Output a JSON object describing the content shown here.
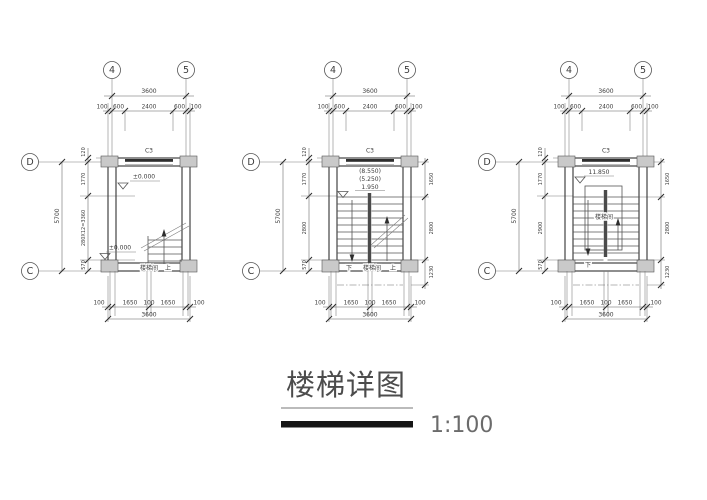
{
  "title": {
    "text": "楼梯详图",
    "scale": "1:100"
  },
  "colors": {
    "line": "#555555",
    "column_fill": "#c9c9c9",
    "window_band": "#2e2e2e",
    "title_bar": "#151515"
  },
  "plans": [
    {
      "grid_top": [
        "4",
        "5"
      ],
      "grid_left": [
        "D",
        "C"
      ],
      "dims_top": {
        "overall": "3600",
        "segments": [
          "100",
          "600",
          "2400",
          "600",
          "100"
        ]
      },
      "dims_left": {
        "overall": "5700",
        "offset": "120",
        "segments": [
          "1770",
          "280X12=3360",
          "570"
        ]
      },
      "window": "C3",
      "elevations": [
        "±0.000",
        "±0.000"
      ],
      "labels": {
        "room": "楼梯间",
        "up": "上"
      },
      "dims_bottom": {
        "segments": [
          "100",
          "1650",
          "100",
          "1650",
          "100"
        ],
        "overall": "3600"
      }
    },
    {
      "grid_top": [
        "4",
        "5"
      ],
      "grid_left": [
        "D",
        "C"
      ],
      "dims_top": {
        "overall": "3600",
        "segments": [
          "100",
          "600",
          "2400",
          "600",
          "100"
        ]
      },
      "dims_left": {
        "overall": "5700",
        "offset": "120",
        "segments": [
          "1770",
          "2800",
          "570"
        ]
      },
      "dims_right": [
        "1650",
        "2800",
        "1230"
      ],
      "window": "C3",
      "elevations": [
        "(8.550)",
        "(5.250)",
        "1.950"
      ],
      "labels": {
        "down": "下",
        "room": "楼梯间",
        "up": "上"
      },
      "dims_bottom": {
        "segments": [
          "100",
          "1650",
          "100",
          "1650",
          "100"
        ],
        "overall": "3600"
      }
    },
    {
      "grid_top": [
        "4",
        "5"
      ],
      "grid_left": [
        "D",
        "C"
      ],
      "dims_top": {
        "overall": "3600",
        "segments": [
          "100",
          "600",
          "2400",
          "600",
          "100"
        ]
      },
      "dims_left": {
        "overall": "5700",
        "offset": "120",
        "segments": [
          "1770",
          "2900",
          "570"
        ]
      },
      "dims_right": [
        "1650",
        "2800",
        "1230"
      ],
      "window": "C3",
      "elevations": [
        "11.850"
      ],
      "labels": {
        "down": "下",
        "room": "楼梯间"
      },
      "dims_bottom": {
        "segments": [
          "100",
          "1650",
          "100",
          "1650",
          "100"
        ],
        "overall": "3600"
      }
    }
  ]
}
